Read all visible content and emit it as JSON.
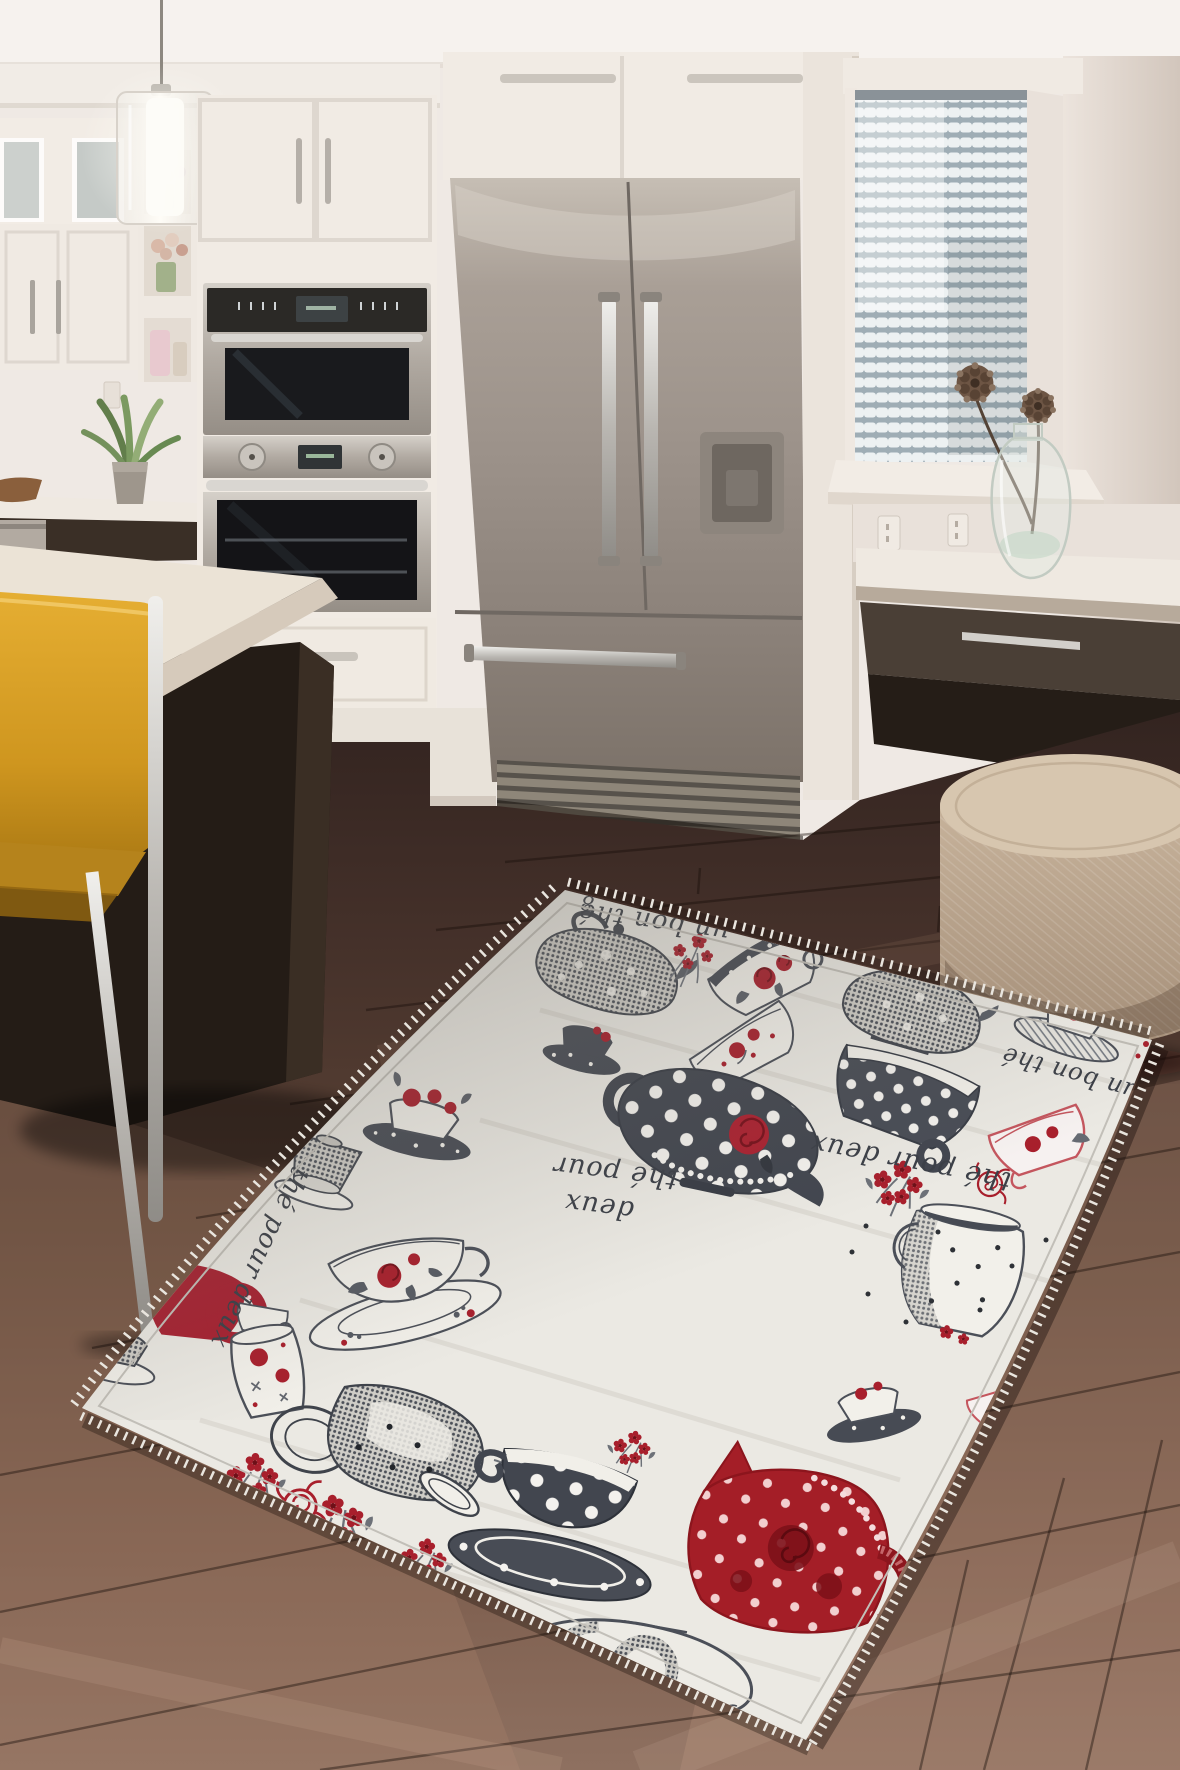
{
  "meta": {
    "type": "product-photo",
    "subject": "Tea-themed washable kitchen area rug shown on dark wood floor in a modern kitchen"
  },
  "palette": {
    "wall": "#efe9e4",
    "ceiling": "#f6f2ee",
    "cabinet_white": "#f2ece5",
    "stainless": "#a89f96",
    "oven_glass": "#17181b",
    "island_base": "#261e18",
    "countertop": "#ebe3d6",
    "chair_yellow": "#cf961f",
    "chrome": "#c9c7c2",
    "floor_dark": "#45312a",
    "floor_light": "#8e7060",
    "pouf": "#c4b098",
    "blinds": "#edf1f2",
    "rug_base": "#ebe9e3",
    "rug_charcoal": "#474b54",
    "rug_red": "#a81f2c",
    "rug_outline": "#4b4f58"
  },
  "kitchen": {
    "objects": [
      "pendant light",
      "upper cabinets",
      "display shelves with flowers",
      "double wall oven",
      "french-door refrigerator",
      "window with venetian blinds",
      "glass vase with pinecones",
      "built-in desk",
      "round woven pouf",
      "kitchen island",
      "yellow sling bar stool",
      "potted succulent",
      "wooden bowl",
      "dark hardwood floor",
      "tea-themed area rug"
    ]
  },
  "rug": {
    "style": "white rug printed with charcoal polka-dot teapots and teacups, red roses and French script",
    "texts": {
      "t0": "8",
      "t1": "un bon thé",
      "t2": "thé pour",
      "t2b": "deux",
      "t3": "thé pour deux",
      "t4": "thé pour deux",
      "t5": "un bon thé"
    },
    "motifs": [
      "lace teapot",
      "flower sprig",
      "rose cup with dotted rim",
      "lace kettle",
      "floral cup",
      "dark saucer cup",
      "polka-dot teapot with rose",
      "tilted polka-dot cup",
      "milk jug",
      "red flower cluster",
      "outline rose",
      "red outline cup",
      "hatched saucer cup",
      "cup with roses on dotted saucer",
      "upside-down cup",
      "elegant teacup with roses",
      "red cup at edge",
      "small outline cup",
      "rose mug",
      "gray cup at edge",
      "big hatched pitcher",
      "large polka-dot cup",
      "red polka-dot teapot with roses",
      "swirl teapot with cherries",
      "dark saucer cup 2",
      "tiny red cup"
    ]
  }
}
